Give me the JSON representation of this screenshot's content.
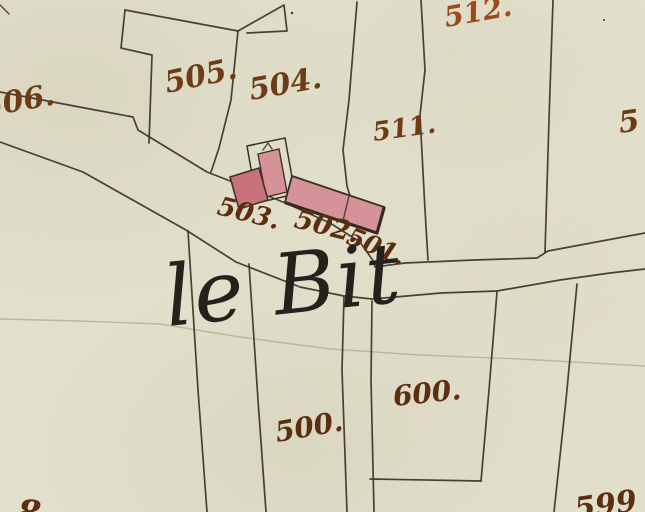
{
  "map": {
    "place_name": "le Bit",
    "parcels": {
      "p506": "506.",
      "p505": "505.",
      "p504": "504.",
      "p512": "512.",
      "p511": "511.",
      "p5cut": "5",
      "p503": "503.",
      "p502": "502.",
      "p501": "501.",
      "p600": "600.",
      "p500": "500.",
      "p599cut": "599",
      "p8cut": "8"
    },
    "colors": {
      "paper": "#e4e1ce",
      "boundary_ink": "#3a332b",
      "label_ink": "#6d3b15",
      "label_ink_dark": "#5c2e10",
      "label_ink_orange": "#9c4a1a",
      "place_ink": "#24221c",
      "building_pink": "#d59298",
      "building_pink_dark": "#c8737b",
      "pencil_line": "#b3b09d"
    }
  }
}
